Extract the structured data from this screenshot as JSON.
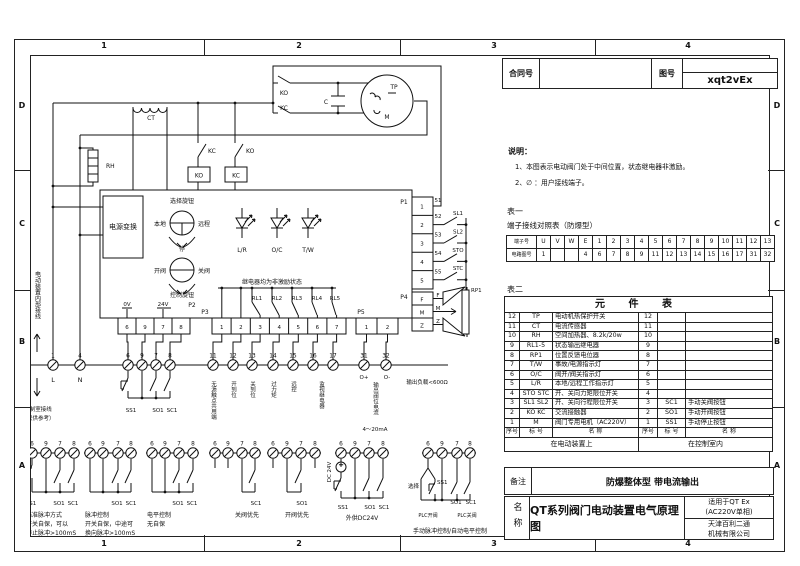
{
  "frame": {
    "cols": [
      "1",
      "2",
      "3",
      "4"
    ],
    "rows": [
      "D",
      "C",
      "B",
      "A"
    ]
  },
  "title_block": {
    "contract_label": "合同号",
    "contract_value": "",
    "drawing_no_label": "图号",
    "drawing_no_value": "xqt2vEx",
    "remark_label": "备注",
    "remark_value": "防爆整体型  带电流输出",
    "name_label": "名称",
    "name_value": "QT系列阀门电动装置电气原理图",
    "applicable1": "适用于QT Ex",
    "applicable2": "(AC220V单相)",
    "company1": "天津百利二通",
    "company2": "机械有限公司"
  },
  "notes": {
    "title": "说明：",
    "line1": "1、本图表示电动阀门处于中间位置，状态继电器非激励。",
    "line2": "2、∅ ：用户接线端子。"
  },
  "table1": {
    "caption": "表一",
    "subtitle": "端子接线对照表（防爆型）",
    "row1_header": "端子号",
    "row2_header": "电路图号",
    "row1": [
      "U",
      "V",
      "W",
      "E",
      "1",
      "2",
      "3",
      "4",
      "5",
      "6",
      "7",
      "8",
      "9",
      "10",
      "11",
      "12",
      "13"
    ],
    "row2": [
      "1",
      "",
      "",
      "4",
      "6",
      "7",
      "8",
      "9",
      "11",
      "12",
      "13",
      "14",
      "15",
      "16",
      "17",
      "31",
      "32"
    ]
  },
  "table2": {
    "caption": "表二",
    "title": "元 件 表",
    "rows": [
      {
        "ln": "12",
        "lt": "TP",
        "lname": "电动机热保护开关",
        "rn": "12",
        "rt": "",
        "rname": ""
      },
      {
        "ln": "11",
        "lt": "CT",
        "lname": "电流传感器",
        "rn": "11",
        "rt": "",
        "rname": ""
      },
      {
        "ln": "10",
        "lt": "RH",
        "lname": "空间加热器、8.2k/20w",
        "rn": "10",
        "rt": "",
        "rname": ""
      },
      {
        "ln": "9",
        "lt": "RL1-5",
        "lname": "状态输出继电器",
        "rn": "9",
        "rt": "",
        "rname": ""
      },
      {
        "ln": "8",
        "lt": "RP1",
        "lname": "位置反馈电位器",
        "rn": "8",
        "rt": "",
        "rname": ""
      },
      {
        "ln": "7",
        "lt": "T/W",
        "lname": "事故/电源指示灯",
        "rn": "7",
        "rt": "",
        "rname": ""
      },
      {
        "ln": "6",
        "lt": "O/C",
        "lname": "阀开/阀关指示灯",
        "rn": "6",
        "rt": "",
        "rname": ""
      },
      {
        "ln": "5",
        "lt": "L/R",
        "lname": "本地/远程工作指示灯",
        "rn": "5",
        "rt": "",
        "rname": ""
      },
      {
        "ln": "4",
        "lt": "STO STC",
        "lname": "开、关向力矩限位开关",
        "rn": "4",
        "rt": "",
        "rname": ""
      },
      {
        "ln": "3",
        "lt": "SL1 SL2",
        "lname": "开、关向行程限位开关",
        "rn": "3",
        "rt": "SC1",
        "rname": "手动关阀按钮"
      },
      {
        "ln": "2",
        "lt": "KO KC",
        "lname": "交流接触器",
        "rn": "2",
        "rt": "SO1",
        "rname": "手动开阀按钮"
      },
      {
        "ln": "1",
        "lt": "M",
        "lname": "阀门专用电机（AC220V）",
        "rn": "1",
        "rt": "SS1",
        "rname": "手动停止按钮"
      }
    ],
    "footer": {
      "seq": "序号",
      "tag": "标 号",
      "name": "名 称"
    },
    "left_zone": "在电动装置上",
    "right_zone": "在控制室内"
  },
  "sch": {
    "ct": "CT",
    "rh": "RH",
    "kc_contact": "KC",
    "ko_coil": "KO",
    "ko_contact": "KO",
    "kc_coil": "KC",
    "ko_motor": "KO",
    "kc_motor": "KC",
    "cap": "C",
    "tp": "TP",
    "motor_m": "M",
    "power_box": "电源变换",
    "sel_knob": "选择旋钮",
    "local": "本地",
    "remote": "远程",
    "stop": "停",
    "open_v": "开阀",
    "close_v": "关阀",
    "ctrl_knob": "控制旋钮",
    "lamps": [
      "L/R",
      "O/C",
      "T/W"
    ],
    "relay_note": "继电器均为非激励状态",
    "rl": [
      "RL1",
      "RL2",
      "RL3",
      "RL4",
      "RL5"
    ],
    "p1": "P1",
    "p2": "P2",
    "p3": "P3",
    "p4": "P4",
    "p5": "P5",
    "v0": "0V",
    "v24": "24V",
    "p1_cells": [
      "1",
      "2",
      "3",
      "4",
      "5"
    ],
    "wires": [
      "51",
      "52",
      "53",
      "54",
      "55"
    ],
    "sw": [
      "SL1",
      "SL2",
      "STO",
      "STC"
    ],
    "p4_cells": [
      "F",
      "M",
      "Z"
    ],
    "p4_wires": [
      "F",
      "M",
      "Z"
    ],
    "rp1": "RP1",
    "p2_cells": [
      "6",
      "9",
      "7",
      "8"
    ],
    "p3_cells": [
      "1",
      "2",
      "3",
      "4",
      "5",
      "6",
      "7"
    ],
    "p5_cells": [
      "1",
      "2"
    ],
    "t_l": "1",
    "t_n": "4",
    "l": "L",
    "n": "N",
    "t_mid": [
      "6",
      "9",
      "7",
      "8"
    ],
    "t_right": [
      "11",
      "12",
      "13",
      "14",
      "15",
      "16",
      "17"
    ],
    "t_out": [
      "31",
      "32"
    ],
    "o_plus": "O+",
    "o_minus": "O-",
    "out_current": "输出阀位电流",
    "out_range": "4～20mA",
    "out_load": "输出负载<600Ω",
    "ss1": "SS1",
    "so1": "SO1",
    "sc1": "SC1",
    "term_labels": [
      "无源触点共用端",
      "开到位",
      "关到位",
      "过力矩",
      "远控",
      "监视继电器"
    ],
    "internal_note": "电动装置内部接线",
    "room_note": "控制室接线",
    "room_note2": "（仅供参考）"
  },
  "groups": [
    {
      "terms": [
        "6",
        "9",
        "7",
        "8"
      ],
      "b1": "SS1",
      "b2": "SO1",
      "b3": "SC1",
      "l1": "标准脉冲方式",
      "l2": "开关自保，可以",
      "l3": "停止脉冲>100mS"
    },
    {
      "terms": [
        "6",
        "9",
        "7",
        "8"
      ],
      "b2": "SO1",
      "b3": "SC1",
      "l1": "脉冲控制",
      "l2": "开关自保，中途可",
      "l3": "换向脉冲>100mS"
    },
    {
      "terms": [
        "6",
        "9",
        "7",
        "8"
      ],
      "b2": "SO1",
      "b3": "SC1",
      "l1": "电平控制",
      "l2": "无自保"
    },
    {
      "terms": [
        "6",
        "9",
        "7",
        "8"
      ],
      "b3": "SC1",
      "l1": "关阀优先"
    },
    {
      "terms": [
        "6",
        "9",
        "7",
        "8"
      ],
      "b2": "SO1",
      "l1": "开阀优先"
    },
    {
      "terms": [
        "6",
        "9",
        "7",
        "8"
      ],
      "b1": "SS1",
      "b2": "SO1",
      "b3": "SC1",
      "dc": "DC 24V",
      "l1": "外供DC24V"
    },
    {
      "terms": [
        "6",
        "9",
        "7",
        "8"
      ],
      "sel": "选择",
      "b1": "SS1",
      "b2": "SO1",
      "b3": "SC1",
      "plc_open": "PLC开阀",
      "plc_close": "PLC关阀",
      "l1": "手动脉冲控制/自动电平控制"
    }
  ]
}
